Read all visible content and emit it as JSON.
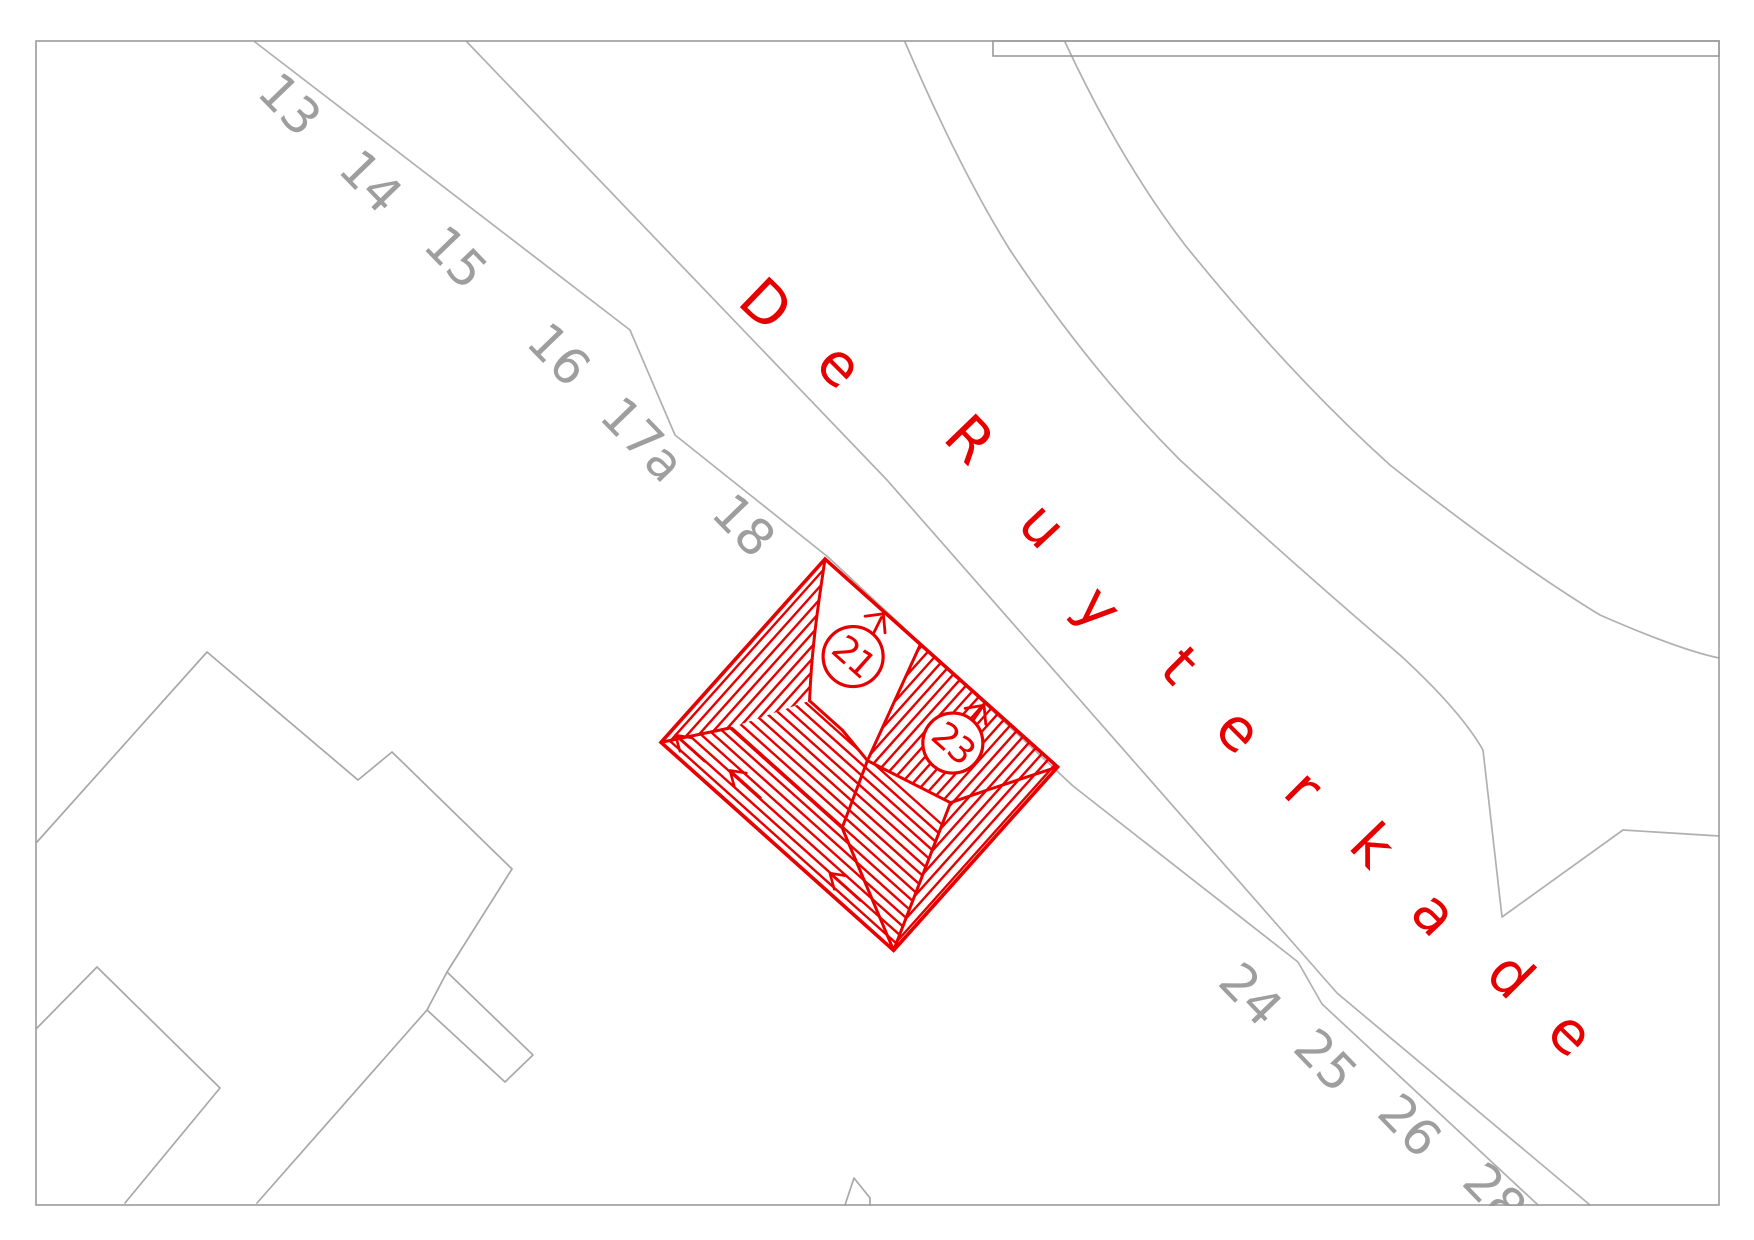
{
  "map": {
    "type_label": "cadastral-roofplan-map",
    "background": "#ffffff",
    "border_color": "#9b9b9b",
    "street_line_color": "#b0b0b0",
    "gray_building_color": "#a8a8a8",
    "house_number_color": "#9e9e9e",
    "highlight_color": "#e60000"
  },
  "street_label": {
    "text": "De Ruyterkade",
    "color": "#e60000",
    "letters": [
      {
        "ch": "D",
        "x": 763,
        "y": 307,
        "rot": 44
      },
      {
        "ch": "e",
        "x": 837,
        "y": 368,
        "rot": 45
      },
      {
        "ch": "R",
        "x": 967,
        "y": 442,
        "rot": 46
      },
      {
        "ch": "u",
        "x": 1040,
        "y": 528,
        "rot": 47
      },
      {
        "ch": "y",
        "x": 1096,
        "y": 610,
        "rot": 48
      },
      {
        "ch": "t",
        "x": 1177,
        "y": 668,
        "rot": 45
      },
      {
        "ch": "e",
        "x": 1236,
        "y": 733,
        "rot": 45
      },
      {
        "ch": "r",
        "x": 1301,
        "y": 791,
        "rot": 45
      },
      {
        "ch": "k",
        "x": 1370,
        "y": 848,
        "rot": 46
      },
      {
        "ch": "a",
        "x": 1432,
        "y": 916,
        "rot": 46
      },
      {
        "ch": "d",
        "x": 1508,
        "y": 978,
        "rot": 45
      },
      {
        "ch": "e",
        "x": 1568,
        "y": 1036,
        "rot": 44
      }
    ]
  },
  "house_numbers": {
    "color": "#9e9e9e",
    "items": [
      {
        "text": "13",
        "x": 287,
        "y": 107,
        "rot": 46
      },
      {
        "text": "14",
        "x": 368,
        "y": 184,
        "rot": 46
      },
      {
        "text": "15",
        "x": 453,
        "y": 260,
        "rot": 46
      },
      {
        "text": "16",
        "x": 556,
        "y": 357,
        "rot": 46
      },
      {
        "text": "17a",
        "x": 640,
        "y": 442,
        "rot": 46
      },
      {
        "text": "18",
        "x": 741,
        "y": 528,
        "rot": 46
      },
      {
        "text": "24",
        "x": 1248,
        "y": 997,
        "rot": 46
      },
      {
        "text": "25",
        "x": 1323,
        "y": 1063,
        "rot": 46
      },
      {
        "text": "26",
        "x": 1407,
        "y": 1128,
        "rot": 46
      },
      {
        "text": "28",
        "x": 1492,
        "y": 1197,
        "rot": 46
      }
    ]
  },
  "building": {
    "color": "#e60000",
    "rotation_deg": 41.8,
    "origin": {
      "x": 825,
      "y": 559
    },
    "units": [
      {
        "number": "21",
        "cx": 86,
        "cy": 54,
        "r": 30
      },
      {
        "number": "23",
        "cx": 218,
        "cy": 52,
        "r": 30
      }
    ]
  }
}
